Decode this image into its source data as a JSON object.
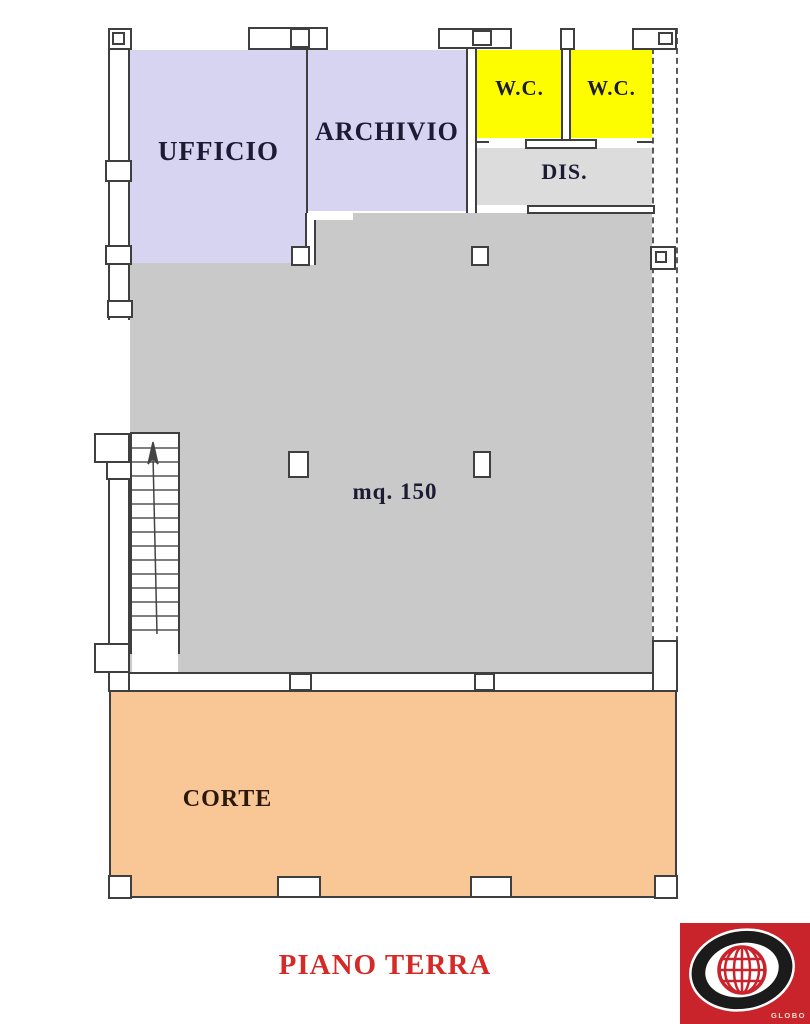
{
  "plan": {
    "title": {
      "text": "PIANO TERRA",
      "color": "#d42a28"
    },
    "rooms": {
      "ufficio": {
        "label": "UFFICIO",
        "color": "#d7d4f1"
      },
      "archivio": {
        "label": "ARCHIVIO",
        "color": "#d7d4f1"
      },
      "wc_left": {
        "label": "W.C.",
        "color": "#fdfd00"
      },
      "wc_right": {
        "label": "W.C.",
        "color": "#fdfd00"
      },
      "dis": {
        "label": "DIS.",
        "color": "#dcdcdc"
      },
      "main_hall": {
        "label": "mq. 150",
        "color": "#c9c9c9"
      },
      "corte": {
        "label": "CORTE",
        "color": "#f9c795"
      }
    },
    "label_color": "#1b1b33",
    "corte_label_color": "#2b190d",
    "features": {
      "stairs_icon": "staircase-with-up-arrow"
    },
    "logo": {
      "text": "GLOBO",
      "background": "#c9242c"
    }
  }
}
